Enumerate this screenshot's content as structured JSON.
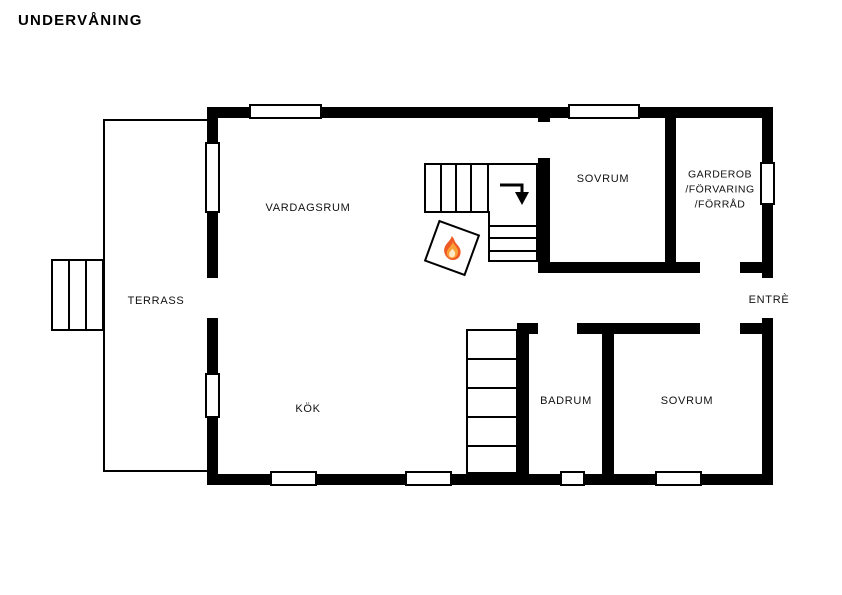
{
  "title": "UNDERVÅNING",
  "rooms": {
    "vardagsrum": {
      "label": "VARDAGSRUM"
    },
    "sovrum_top": {
      "label": "SOVRUM"
    },
    "garderob": {
      "label_line1": "GARDEROB",
      "label_line2": "/FÖRVARING",
      "label_line3": "/FÖRRÅD"
    },
    "terrass": {
      "label": "TERRASS"
    },
    "entre": {
      "label": "ENTRÈ"
    },
    "kok": {
      "label": "KÖK"
    },
    "badrum": {
      "label": "BADRUM"
    },
    "sovrum_bottom": {
      "label": "SOVRUM"
    }
  },
  "icons": {
    "fireplace": "flame-icon",
    "stair_direction": "down-right-arrow-icon"
  },
  "colors": {
    "wall": "#000000",
    "background": "#ffffff",
    "flame_outer": "#ef5a24",
    "flame_mid": "#f9a136",
    "flame_core": "#fdeac8"
  }
}
